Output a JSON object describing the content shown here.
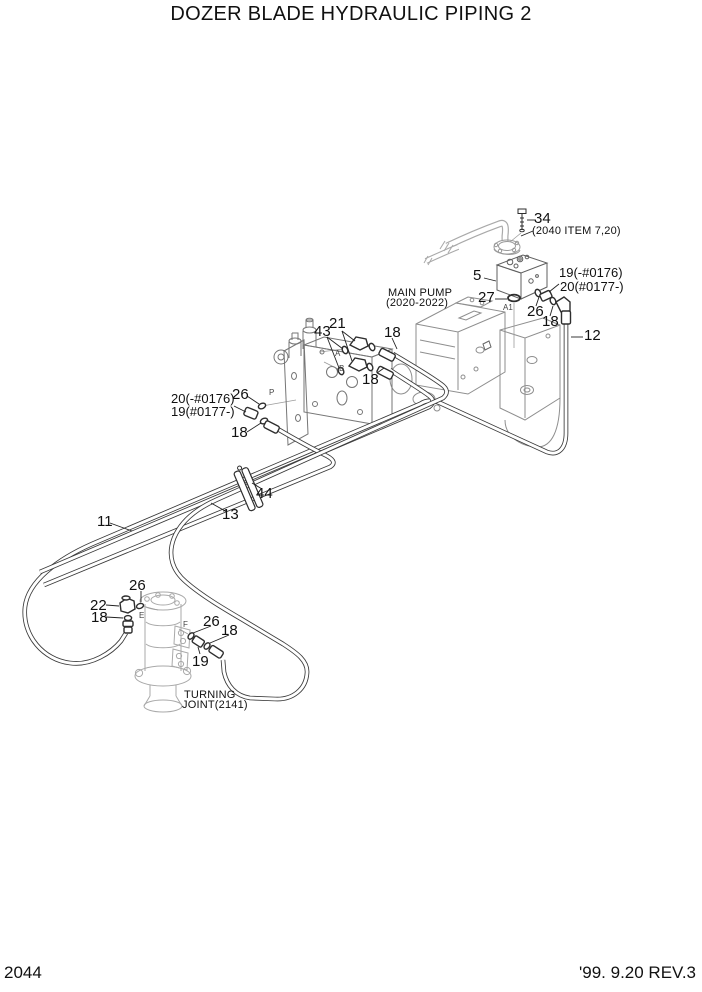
{
  "page": {
    "title": "DOZER BLADE HYDRAULIC PIPING 2",
    "page_number": "2044",
    "revision": "'99. 9.20 REV.3"
  },
  "diagram": {
    "notes": {
      "item_34_note": "(2040 ITEM 7,20)",
      "main_pump_line1": "MAIN PUMP",
      "main_pump_line2": "(2020-2022)",
      "turning_joint_line1": "TURNING",
      "turning_joint_line2": "JOINT(2141)"
    },
    "callouts": [
      {
        "text": "34"
      },
      {
        "text": "5"
      },
      {
        "text": "19(-#0176)"
      },
      {
        "text": "20(#0177-)"
      },
      {
        "text": "27"
      },
      {
        "text": "26"
      },
      {
        "text": "18"
      },
      {
        "text": "12"
      },
      {
        "text": "43"
      },
      {
        "text": "21"
      },
      {
        "text": "18"
      },
      {
        "text": "18"
      },
      {
        "text": "26"
      },
      {
        "text": "20(-#0176)"
      },
      {
        "text": "19(#0177-)"
      },
      {
        "text": "18"
      },
      {
        "text": "44"
      },
      {
        "text": "13"
      },
      {
        "text": "11"
      },
      {
        "text": "26"
      },
      {
        "text": "22"
      },
      {
        "text": "18"
      },
      {
        "text": "26"
      },
      {
        "text": "18"
      },
      {
        "text": "19"
      }
    ],
    "ports": {
      "a1": "A1",
      "a": "A",
      "b": "B",
      "p": "P",
      "e": "E",
      "f": "F"
    },
    "colors": {
      "hose_line": "#3a3a3a",
      "fitting_line": "#2e2e2e",
      "pump_line": "#8e8e8e",
      "gear_pump_line": "#767676",
      "valve_block_line": "#5f5f5f",
      "reference_line": "#a9a9a9",
      "leader_line": "#222222",
      "text": "#111111",
      "background": "#ffffff"
    }
  }
}
